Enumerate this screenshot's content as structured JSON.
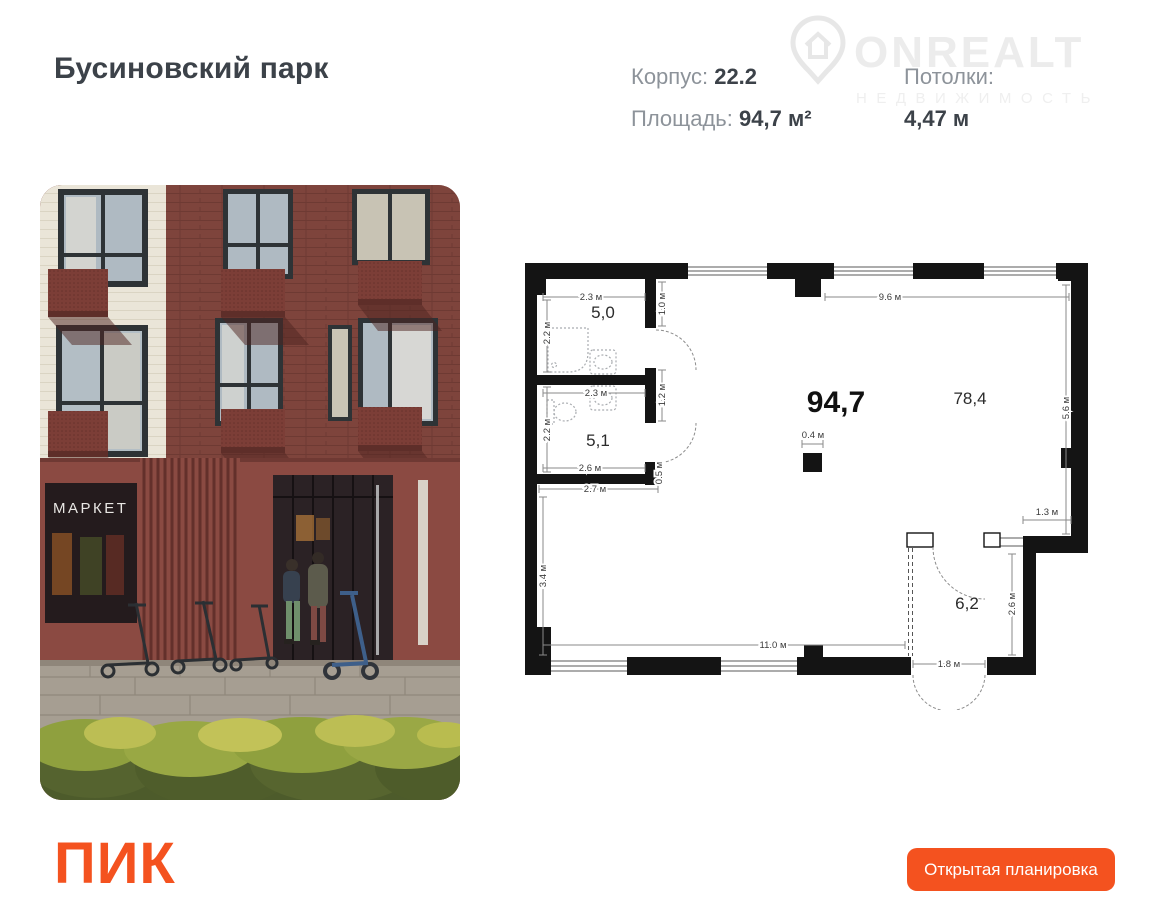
{
  "header": {
    "title": "Бусиновский парк",
    "korpus_label": "Корпус:",
    "korpus_value": "22.2",
    "area_label": "Площадь:",
    "area_value": "94,7 м²",
    "ceilings_label": "Потолки:",
    "ceilings_value": "4,47 м"
  },
  "watermark": {
    "brand": "ONREALT",
    "tagline": "НЕДВИЖИМОСТЬ"
  },
  "photo": {
    "storefront_sign": "МАРКЕТ"
  },
  "floorplan": {
    "total_area_label": "94,7",
    "open_space_label": "78,4",
    "room_small_top_label": "5,0",
    "room_small_bottom_label": "5,1",
    "room_entry_label": "6,2",
    "column_dim": "0.4 м",
    "dims": [
      {
        "id": "room50-width",
        "text": "2.3 м"
      },
      {
        "id": "room50-depth",
        "text": "2.2 м"
      },
      {
        "id": "pier-offset",
        "text": "1.0 м"
      },
      {
        "id": "top-span",
        "text": "9.6 м"
      },
      {
        "id": "room51-width",
        "text": "2.3 м"
      },
      {
        "id": "door-gap",
        "text": "1.2 м"
      },
      {
        "id": "room51-depth",
        "text": "2.2 м"
      },
      {
        "id": "room51-bottom-width",
        "text": "2.6 м"
      },
      {
        "id": "wall-stub",
        "text": "0.5 м"
      },
      {
        "id": "lower-width",
        "text": "2.7 м"
      },
      {
        "id": "left-span",
        "text": "3.4 м"
      },
      {
        "id": "right-span",
        "text": "5.6 м"
      },
      {
        "id": "notch-width",
        "text": "1.3 м"
      },
      {
        "id": "room62-depth",
        "text": "2.6 м"
      },
      {
        "id": "bottom-span",
        "text": "11.0 м"
      },
      {
        "id": "entry-door-width",
        "text": "1.8 м"
      }
    ]
  },
  "footer": {
    "developer_logo": "ПИК",
    "action_button": "Открытая планировка"
  },
  "colors": {
    "accent_orange": "#F4521F",
    "text_dark": "#3C4249",
    "text_gray": "#8D939A",
    "plan_wall": "#141414"
  }
}
